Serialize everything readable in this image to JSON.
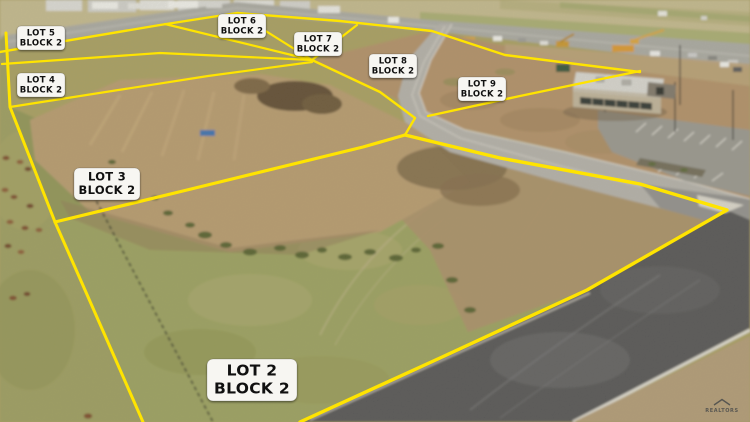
{
  "image": {
    "width": 750,
    "height": 422
  },
  "colors": {
    "lot_line": "#ffe400",
    "label_bg": "#f7f6f2",
    "label_text": "#101010"
  },
  "lots": {
    "lot2": {
      "name": "LOT 2",
      "block": "BLOCK 2"
    },
    "lot3": {
      "name": "LOT 3",
      "block": "BLOCK 2"
    },
    "lot4": {
      "name": "LOT 4",
      "block": "BLOCK 2"
    },
    "lot5": {
      "name": "LOT 5",
      "block": "BLOCK 2"
    },
    "lot6": {
      "name": "LOT 6",
      "block": "BLOCK 2"
    },
    "lot7": {
      "name": "LOT 7",
      "block": "BLOCK 2"
    },
    "lot8": {
      "name": "LOT 8",
      "block": "BLOCK 2"
    },
    "lot9": {
      "name": "LOT 9",
      "block": "BLOCK 2"
    }
  },
  "watermark": {
    "text": "REALTORS"
  }
}
